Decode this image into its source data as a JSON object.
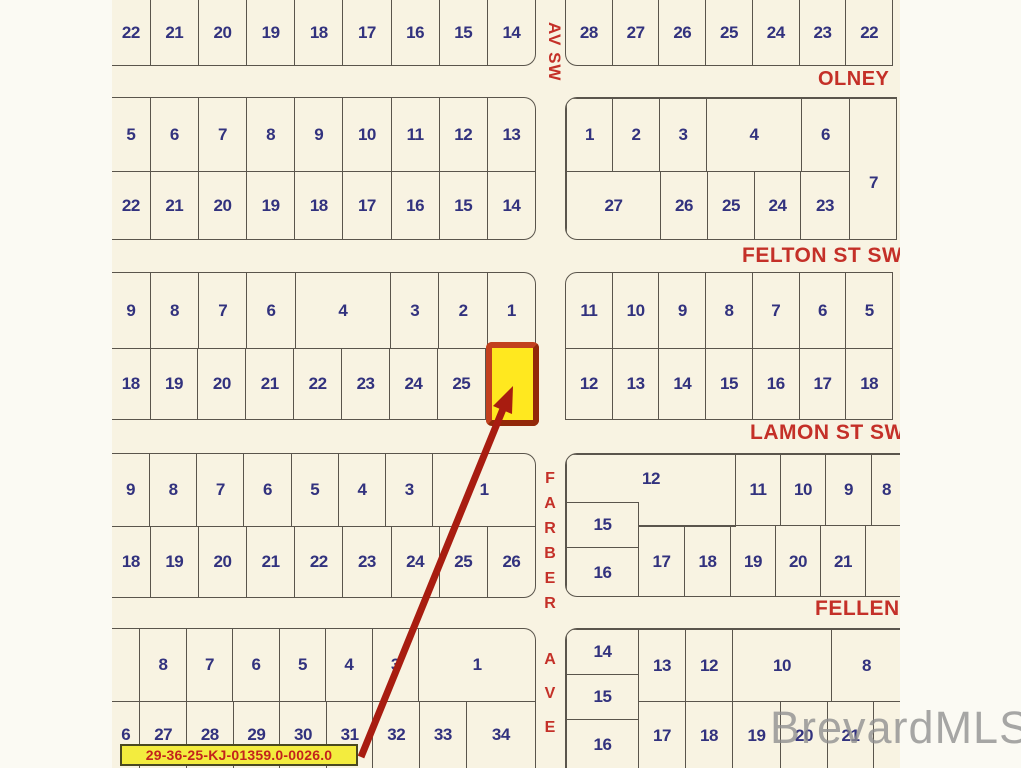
{
  "map": {
    "watermark": "BrevardMLS",
    "parcel_label": "29-36-25-KJ-01359.0-0026.0",
    "streets": {
      "av_sw": "AV SW",
      "olney": "OLNEY",
      "felton": "FELTON ST SW",
      "lamon": "LAMON ST SW",
      "farber": "FARBER",
      "fellen": "FELLEN",
      "ave": "AVE"
    },
    "colors": {
      "map_bg": "#f8f3e2",
      "margin_bg": "#fbfaf3",
      "lot_line": "#5a554c",
      "lot_number": "#32327e",
      "street_name": "#c43028",
      "highlight_fill": "#ffe81f",
      "highlight_border": "#a93410",
      "arrow": "#a81c10",
      "label_bg": "#f3ec3e",
      "label_text": "#c3231c",
      "watermark": "#8f8f8f"
    },
    "highlight": {
      "x": 486,
      "y": 342,
      "w": 53,
      "h": 84
    },
    "arrow": {
      "x1": 361,
      "y1": 757,
      "x2": 503,
      "y2": 409,
      "head": "513,386 512,414 493,406"
    },
    "blocks": [
      {
        "id": "r1-west",
        "x": 112,
        "y": 0,
        "w": 424,
        "h": 66,
        "cut": [
          "t",
          "l"
        ],
        "round": [
          "br"
        ],
        "rows": [
          {
            "cells": [
              {
                "n": "22",
                "w": 0.8
              },
              {
                "n": "21"
              },
              {
                "n": "20"
              },
              {
                "n": "19"
              },
              {
                "n": "18"
              },
              {
                "n": "17"
              },
              {
                "n": "16"
              },
              {
                "n": "15"
              },
              {
                "n": "14"
              }
            ]
          }
        ]
      },
      {
        "id": "r1-east",
        "x": 565,
        "y": 0,
        "w": 328,
        "h": 66,
        "cut": [
          "t"
        ],
        "round": [
          "bl"
        ],
        "rows": [
          {
            "cells": [
              {
                "n": "28"
              },
              {
                "n": "27"
              },
              {
                "n": "26"
              },
              {
                "n": "25"
              },
              {
                "n": "24"
              },
              {
                "n": "23"
              },
              {
                "n": "22"
              }
            ]
          }
        ]
      },
      {
        "id": "r2-west",
        "x": 112,
        "y": 97,
        "w": 424,
        "h": 143,
        "cut": [
          "l"
        ],
        "round": [
          "tr",
          "br"
        ],
        "rows": [
          {
            "h": 73,
            "cells": [
              {
                "n": "5",
                "w": 0.8
              },
              {
                "n": "6"
              },
              {
                "n": "7"
              },
              {
                "n": "8"
              },
              {
                "n": "9"
              },
              {
                "n": "10"
              },
              {
                "n": "11"
              },
              {
                "n": "12"
              },
              {
                "n": "13"
              }
            ]
          },
          {
            "cells": [
              {
                "n": "22",
                "w": 0.8
              },
              {
                "n": "21"
              },
              {
                "n": "20"
              },
              {
                "n": "19"
              },
              {
                "n": "18"
              },
              {
                "n": "17"
              },
              {
                "n": "16"
              },
              {
                "n": "15"
              },
              {
                "n": "14"
              }
            ]
          }
        ]
      },
      {
        "id": "r2-east",
        "x": 565,
        "y": 97,
        "w": 332,
        "h": 143,
        "round": [
          "tl",
          "bl"
        ],
        "cells": [
          {
            "n": "1",
            "x": 0,
            "y": 0,
            "w": 47,
            "h": 74
          },
          {
            "n": "2",
            "x": 46,
            "y": 0,
            "w": 48,
            "h": 74
          },
          {
            "n": "3",
            "x": 93,
            "y": 0,
            "w": 48,
            "h": 74
          },
          {
            "n": "4",
            "x": 140,
            "y": 0,
            "w": 96,
            "h": 74
          },
          {
            "n": "6",
            "x": 235,
            "y": 0,
            "w": 49,
            "h": 74
          },
          {
            "n": "7",
            "x": 283,
            "y": 0,
            "w": 49,
            "h": 143,
            "nyf": 0.52
          },
          {
            "n": "27",
            "x": 0,
            "y": 73,
            "w": 95,
            "h": 70
          },
          {
            "n": "26",
            "x": 94,
            "y": 73,
            "w": 48,
            "h": 70
          },
          {
            "n": "25",
            "x": 141,
            "y": 73,
            "w": 48,
            "h": 70
          },
          {
            "n": "24",
            "x": 188,
            "y": 73,
            "w": 47,
            "h": 70
          },
          {
            "n": "23",
            "x": 234,
            "y": 73,
            "w": 50,
            "h": 70
          }
        ]
      },
      {
        "id": "r3-west",
        "x": 112,
        "y": 272,
        "w": 424,
        "h": 148,
        "cut": [
          "l"
        ],
        "round": [
          "tr"
        ],
        "rows": [
          {
            "h": 75,
            "cells": [
              {
                "n": "9",
                "w": 0.8
              },
              {
                "n": "8"
              },
              {
                "n": "7"
              },
              {
                "n": "6"
              },
              {
                "n": "4",
                "w": 2
              },
              {
                "n": "3"
              },
              {
                "n": "2"
              },
              {
                "n": "1"
              }
            ]
          },
          {
            "cells": [
              {
                "n": "18",
                "w": 0.8
              },
              {
                "n": "19"
              },
              {
                "n": "20"
              },
              {
                "n": "21"
              },
              {
                "n": "22"
              },
              {
                "n": "23"
              },
              {
                "n": "24"
              },
              {
                "n": "25"
              },
              {
                "n": "",
                "w": 1.05
              }
            ]
          }
        ]
      },
      {
        "id": "r3-east",
        "x": 565,
        "y": 272,
        "w": 328,
        "h": 148,
        "round": [
          "tl"
        ],
        "rows": [
          {
            "h": 75,
            "cells": [
              {
                "n": "11"
              },
              {
                "n": "10"
              },
              {
                "n": "9"
              },
              {
                "n": "8"
              },
              {
                "n": "7"
              },
              {
                "n": "6"
              },
              {
                "n": "5"
              }
            ]
          },
          {
            "cells": [
              {
                "n": "12"
              },
              {
                "n": "13"
              },
              {
                "n": "14"
              },
              {
                "n": "15"
              },
              {
                "n": "16"
              },
              {
                "n": "17"
              },
              {
                "n": "18"
              }
            ]
          }
        ]
      },
      {
        "id": "r4-west",
        "x": 112,
        "y": 453,
        "w": 424,
        "h": 145,
        "cut": [
          "l"
        ],
        "round": [
          "tr",
          "br"
        ],
        "rows": [
          {
            "h": 72,
            "cells": [
              {
                "n": "9",
                "w": 0.8
              },
              {
                "n": "8"
              },
              {
                "n": "7"
              },
              {
                "n": "6"
              },
              {
                "n": "5"
              },
              {
                "n": "4"
              },
              {
                "n": "3"
              },
              {
                "n": "1",
                "w": 2.2
              }
            ]
          },
          {
            "cells": [
              {
                "n": "18",
                "w": 0.8
              },
              {
                "n": "19"
              },
              {
                "n": "20"
              },
              {
                "n": "21"
              },
              {
                "n": "22"
              },
              {
                "n": "23"
              },
              {
                "n": "24"
              },
              {
                "n": "25"
              },
              {
                "n": "26"
              }
            ]
          }
        ]
      },
      {
        "id": "r4-east",
        "x": 565,
        "y": 453,
        "w": 335,
        "h": 144,
        "cut": [
          "r"
        ],
        "round": [
          "tl",
          "bl"
        ],
        "cells": [
          {
            "n": "12",
            "x": 0,
            "y": 0,
            "w": 170,
            "h": 49,
            "cutc": "b"
          },
          {
            "n": "",
            "x": 72,
            "y": 48,
            "w": 98,
            "h": 25,
            "cutc": "t"
          },
          {
            "n": "11",
            "x": 169,
            "y": 0,
            "w": 46,
            "h": 72
          },
          {
            "n": "10",
            "x": 214,
            "y": 0,
            "w": 46,
            "h": 72
          },
          {
            "n": "9",
            "x": 259,
            "y": 0,
            "w": 47,
            "h": 72
          },
          {
            "n": "8",
            "x": 305,
            "y": 0,
            "w": 30,
            "h": 72,
            "cutc": "r"
          },
          {
            "n": "15",
            "x": 0,
            "y": 48,
            "w": 73,
            "h": 46
          },
          {
            "n": "16",
            "x": 0,
            "y": 93,
            "w": 73,
            "h": 51
          },
          {
            "n": "17",
            "x": 72,
            "y": 71,
            "w": 47,
            "h": 73
          },
          {
            "n": "18",
            "x": 118,
            "y": 71,
            "w": 47,
            "h": 73
          },
          {
            "n": "19",
            "x": 164,
            "y": 71,
            "w": 46,
            "h": 73
          },
          {
            "n": "20",
            "x": 209,
            "y": 71,
            "w": 46,
            "h": 73
          },
          {
            "n": "21",
            "x": 254,
            "y": 71,
            "w": 46,
            "h": 73
          },
          {
            "n": "",
            "x": 299,
            "y": 71,
            "w": 36,
            "h": 73,
            "cutc": "r"
          }
        ]
      },
      {
        "id": "r5-west",
        "x": 112,
        "y": 628,
        "w": 424,
        "h": 140,
        "cut": [
          "l",
          "b"
        ],
        "round": [
          "tr"
        ],
        "rows": [
          {
            "h": 72,
            "cells": [
              {
                "n": "",
                "w": 0.6
              },
              {
                "n": "8"
              },
              {
                "n": "7"
              },
              {
                "n": "6"
              },
              {
                "n": "5"
              },
              {
                "n": "4"
              },
              {
                "n": "3"
              },
              {
                "n": "1",
                "w": 2.55
              }
            ]
          },
          {
            "cells": [
              {
                "n": "6",
                "w": 0.6
              },
              {
                "n": "27"
              },
              {
                "n": "28"
              },
              {
                "n": "29"
              },
              {
                "n": "30"
              },
              {
                "n": "31"
              },
              {
                "n": "32"
              },
              {
                "n": "33"
              },
              {
                "n": "34",
                "w": 1.5
              }
            ]
          }
        ]
      },
      {
        "id": "r5-east",
        "x": 565,
        "y": 628,
        "w": 335,
        "h": 140,
        "cut": [
          "r",
          "b"
        ],
        "round": [
          "tl"
        ],
        "cells": [
          {
            "n": "14",
            "x": 0,
            "y": 0,
            "w": 73,
            "h": 46
          },
          {
            "n": "15",
            "x": 0,
            "y": 45,
            "w": 73,
            "h": 46
          },
          {
            "n": "16",
            "x": 0,
            "y": 90,
            "w": 73,
            "h": 50,
            "cutc": "b"
          },
          {
            "n": "13",
            "x": 72,
            "y": 0,
            "w": 48,
            "h": 73
          },
          {
            "n": "12",
            "x": 119,
            "y": 0,
            "w": 48,
            "h": 73
          },
          {
            "n": "10",
            "x": 166,
            "y": 0,
            "w": 100,
            "h": 73
          },
          {
            "n": "8",
            "x": 265,
            "y": 0,
            "w": 70,
            "h": 73,
            "cutc": "r"
          },
          {
            "n": "17",
            "x": 72,
            "y": 72,
            "w": 48,
            "h": 68,
            "cutc": "b"
          },
          {
            "n": "18",
            "x": 119,
            "y": 72,
            "w": 48,
            "h": 68,
            "cutc": "b"
          },
          {
            "n": "19",
            "x": 166,
            "y": 72,
            "w": 49,
            "h": 68,
            "cutc": "b"
          },
          {
            "n": "20",
            "x": 214,
            "y": 72,
            "w": 48,
            "h": 68,
            "cutc": "b"
          },
          {
            "n": "21",
            "x": 261,
            "y": 72,
            "w": 47,
            "h": 68,
            "cutc": "b"
          },
          {
            "n": "",
            "x": 307,
            "y": 72,
            "w": 28,
            "h": 68,
            "cutc": "rb"
          }
        ]
      }
    ]
  }
}
